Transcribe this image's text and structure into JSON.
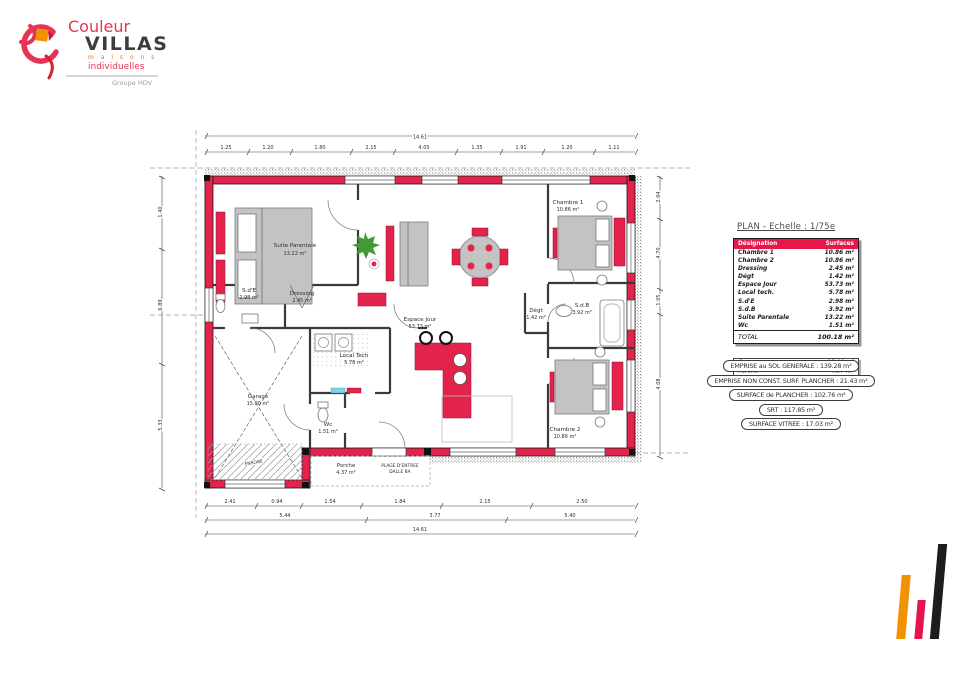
{
  "logo": {
    "brand_top": "Couleur",
    "brand_bottom": "VILLAS",
    "tagline1": "m a i s o n s",
    "tagline2": "individuelles",
    "group": "Groupe HDV"
  },
  "panel": {
    "title": "PLAN - Echelle : 1/75e",
    "table": {
      "headers": [
        "Désignation",
        "Surfaces"
      ],
      "rows": [
        [
          "Chambre 1",
          "10.86 m²"
        ],
        [
          "Chambre 2",
          "10.86 m²"
        ],
        [
          "Dressing",
          "2.45 m²"
        ],
        [
          "Dégt",
          "1.42 m²"
        ],
        [
          "Espace Jour",
          "53.73 m²"
        ],
        [
          "Local tech.",
          "5.78 m²"
        ],
        [
          "S.d'E",
          "2.98 m²"
        ],
        [
          "S.d.B",
          "3.92 m²"
        ],
        [
          "Suite Parentale",
          "13.22 m²"
        ],
        [
          "Wc",
          "1.51 m²"
        ]
      ],
      "total_label": "TOTAL",
      "total_value": "100.18 m²"
    },
    "annex_rows": [
      [
        "Garage",
        "15.00 m²"
      ],
      [
        "Porche",
        "4.37 m²"
      ]
    ],
    "badges": [
      "EMPRISE au SOL GENERALE : 139.28 m²",
      "EMPRISE NON CONST. SURF. PLANCHER : 21.43 m²",
      "SURFACE de PLANCHER : 102.76 m²",
      "SRT : 117.85 m²",
      "SURFACE VITREE : 17.03 m²"
    ]
  },
  "plan": {
    "rooms": [
      {
        "name": "Suite Parentale",
        "area": "13.22 m²"
      },
      {
        "name": "Dressing",
        "area": "2.45 m²"
      },
      {
        "name": "S.d'E",
        "area": "2.98 m²"
      },
      {
        "name": "Espace Jour",
        "area": "53.73 m²"
      },
      {
        "name": "Local Tech",
        "area": "5.78 m²"
      },
      {
        "name": "Wc",
        "area": "1.51 m²"
      },
      {
        "name": "Garage",
        "area": "15.00 m²"
      },
      {
        "name": "Chambre 1",
        "area": "10.86 m²"
      },
      {
        "name": "S.d.B",
        "area": "3.92 m²"
      },
      {
        "name": "Dégt",
        "area": "1.42 m²"
      },
      {
        "name": "Chambre 2",
        "area": "10.86 m²"
      },
      {
        "name": "Porche",
        "area": "4.37 m²"
      }
    ],
    "annotations": {
      "plage1": "PLAGE D'ENTREE",
      "plage2": "DALLE BA",
      "enrobe": "ENROBE"
    },
    "dimensions": {
      "overall": "14.61",
      "top_segments": [
        "1.25",
        "1.20",
        "1.80",
        "2.15",
        "4.05",
        "1.35",
        "1.91",
        "1.20",
        "1.11"
      ],
      "left_segments": [
        "1.40",
        "6.89",
        "5.33"
      ],
      "right_segments": [
        "2.04",
        "4.70",
        "1.05",
        "4.08"
      ],
      "bottom_row1": [
        "2.41",
        "0.94",
        "1.54",
        "1.84",
        "2.15",
        "2.50"
      ],
      "bottom_row2": [
        "5.44",
        "3.77",
        "5.40"
      ]
    }
  },
  "colors": {
    "wall_red": "#E3234C",
    "header_red": "#E8174A",
    "logo_pink": "#E73356",
    "logo_orange": "#F39200",
    "bar_black": "#1d1d1b"
  }
}
